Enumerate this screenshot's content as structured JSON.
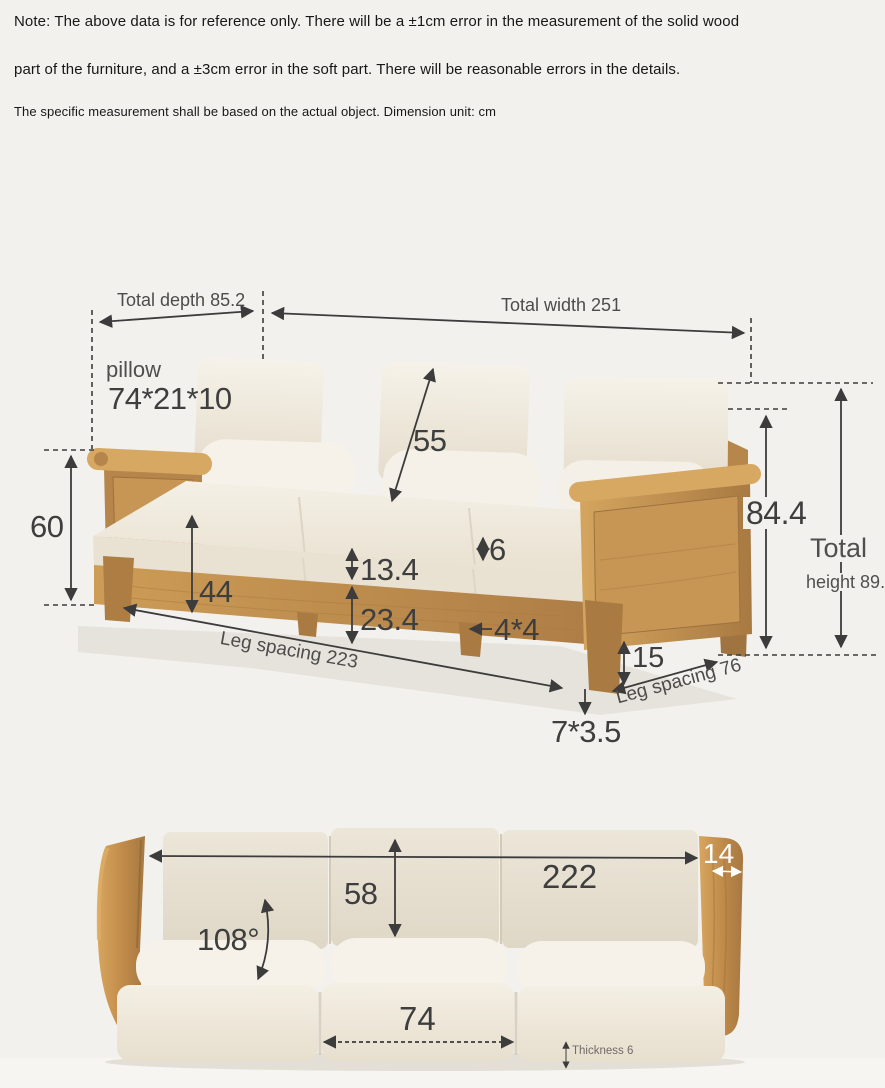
{
  "notes": {
    "line1": "Note: The above data is for reference only. There will be a ±1cm error in the measurement of the solid wood",
    "line2": "part of the furniture, and a ±3cm error in the soft part. There will be reasonable errors in the details.",
    "line3": "The specific measurement shall be based on the actual object. Dimension unit: cm"
  },
  "unit": "cm",
  "side_view": {
    "total_depth_label": "Total depth 85.2",
    "total_width_label": "Total width 251",
    "pillow_label": "pillow",
    "pillow_size": "74*21*10",
    "backrest_cushion_height": "55",
    "armrest_height": "60",
    "seat_height": "44",
    "seat_cushion_thickness": "13.4",
    "cushion_rise": "6",
    "apron_height": "23.4",
    "middle_leg_size": "4*4",
    "front_leg_spacing_label": "Leg spacing 223",
    "leg_height": "15",
    "side_leg_spacing_label": "Leg spacing 76",
    "foot_size": "7*3.5",
    "back_height": "84.4",
    "total_height_word": "Total",
    "total_height_value": "height 89.2"
  },
  "front_view": {
    "inner_width": "222",
    "armrest_thickness": "14",
    "backrest_height": "58",
    "backrest_angle": "108°",
    "seat_cushion_width": "74",
    "mat_thickness_label": "Thickness 6"
  },
  "colors": {
    "background": "#f2f1ee",
    "wood_light": "#d7a862",
    "wood_mid": "#c08e4e",
    "wood_dark": "#9d7240",
    "cushion": "#f1ece2",
    "dim_line": "#3c3c3c",
    "note_text": "#171717",
    "white_label": "#ffffff"
  }
}
